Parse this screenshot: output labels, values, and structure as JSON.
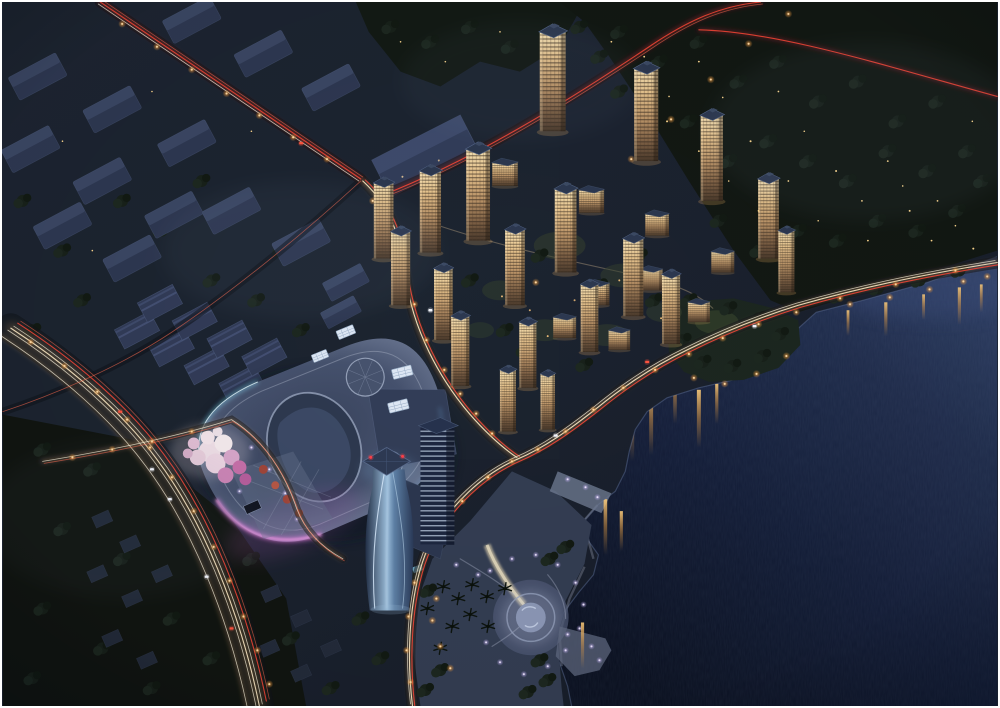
{
  "scene": {
    "title": "Night aerial rendering of a lakeside mixed-use development",
    "type": "architectural-rendering",
    "time_of_day": "night",
    "view": "aerial-oblique",
    "regions": {
      "industrial_district": "Rows of dark warehouse and factory buildings in the upper left",
      "residential_estate": "Cluster of high-rise apartment towers with warm lit windows in the center",
      "shopping_mall": "Organic rounded-roof shopping mall with magenta rim lighting and cyan accents",
      "office_tower": "Twisted blue glass landmark tower beside the mall",
      "blossom_grove": "Pink flowering trees beside the mall plaza",
      "waterfront_park": "Lakeside plaza with circular fountain, palm trees and piers",
      "headland_park": "Tree-covered headland jutting into the lake",
      "lake": "Dark lake filling the right and lower right with light reflections",
      "forest": "Dark woodland with scattered lights across the top right",
      "village": "Small dark houses among trees in the lower left",
      "roads": "Boulevards with headlight and taillight light trails and orange street lamps"
    },
    "palette": {
      "land": "#1b2230",
      "forest": "#131a15",
      "water_deep": "#0a1020",
      "water_shore": "#31436a",
      "window_warm": "#e7c48e",
      "roof_blue": "#2c3850",
      "mall_rim_magenta": "#e27fe2",
      "mall_rim_cyan": "#7fd4ef",
      "tail_light_red": "#ff4838",
      "head_light_white": "#ffedc8",
      "street_lamp_orange": "#e8973f",
      "park_lamp_violet": "#d8c8f8",
      "blossom_pink": "#eed7e4",
      "fountain_glow": "#cfd8f2"
    }
  }
}
